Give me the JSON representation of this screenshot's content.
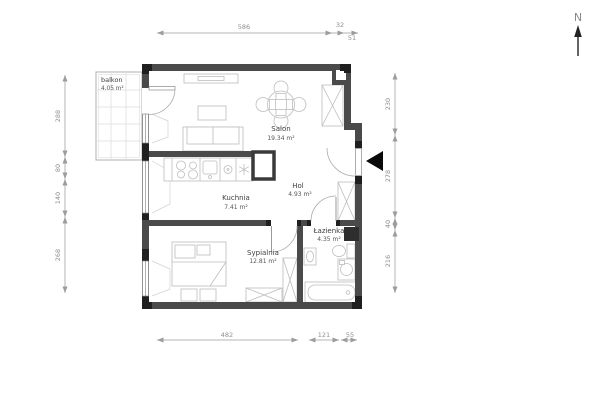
{
  "title": "apartment-floor-plan",
  "compass": {
    "label": "N"
  },
  "rooms": {
    "balkon": {
      "name": "balkon",
      "area": "4.05 m²"
    },
    "salon": {
      "name": "Salon",
      "area": "19.34 m²"
    },
    "kuchnia": {
      "name": "Kuchnia",
      "area": "7.41 m²"
    },
    "hol": {
      "name": "Hol",
      "area": "4.93 m²"
    },
    "lazienka": {
      "name": "Łazienka",
      "area": "4.35 m²"
    },
    "sypialnia": {
      "name": "Sypialnia",
      "area": "12.81 m²"
    }
  },
  "dimensions": {
    "top": [
      "586",
      "32",
      "51"
    ],
    "left": [
      "288",
      "80",
      "140",
      "268"
    ],
    "right": [
      "230",
      "278",
      "40",
      "216"
    ],
    "bottom": [
      "482",
      "121",
      "55"
    ]
  },
  "colors": {
    "wall": "#4a4a4a",
    "wall_dark": "#1f1f1f",
    "dimension": "#9a9a9a",
    "furniture": "#bdbdbd",
    "entrance_marker": "#0a0a0a"
  }
}
